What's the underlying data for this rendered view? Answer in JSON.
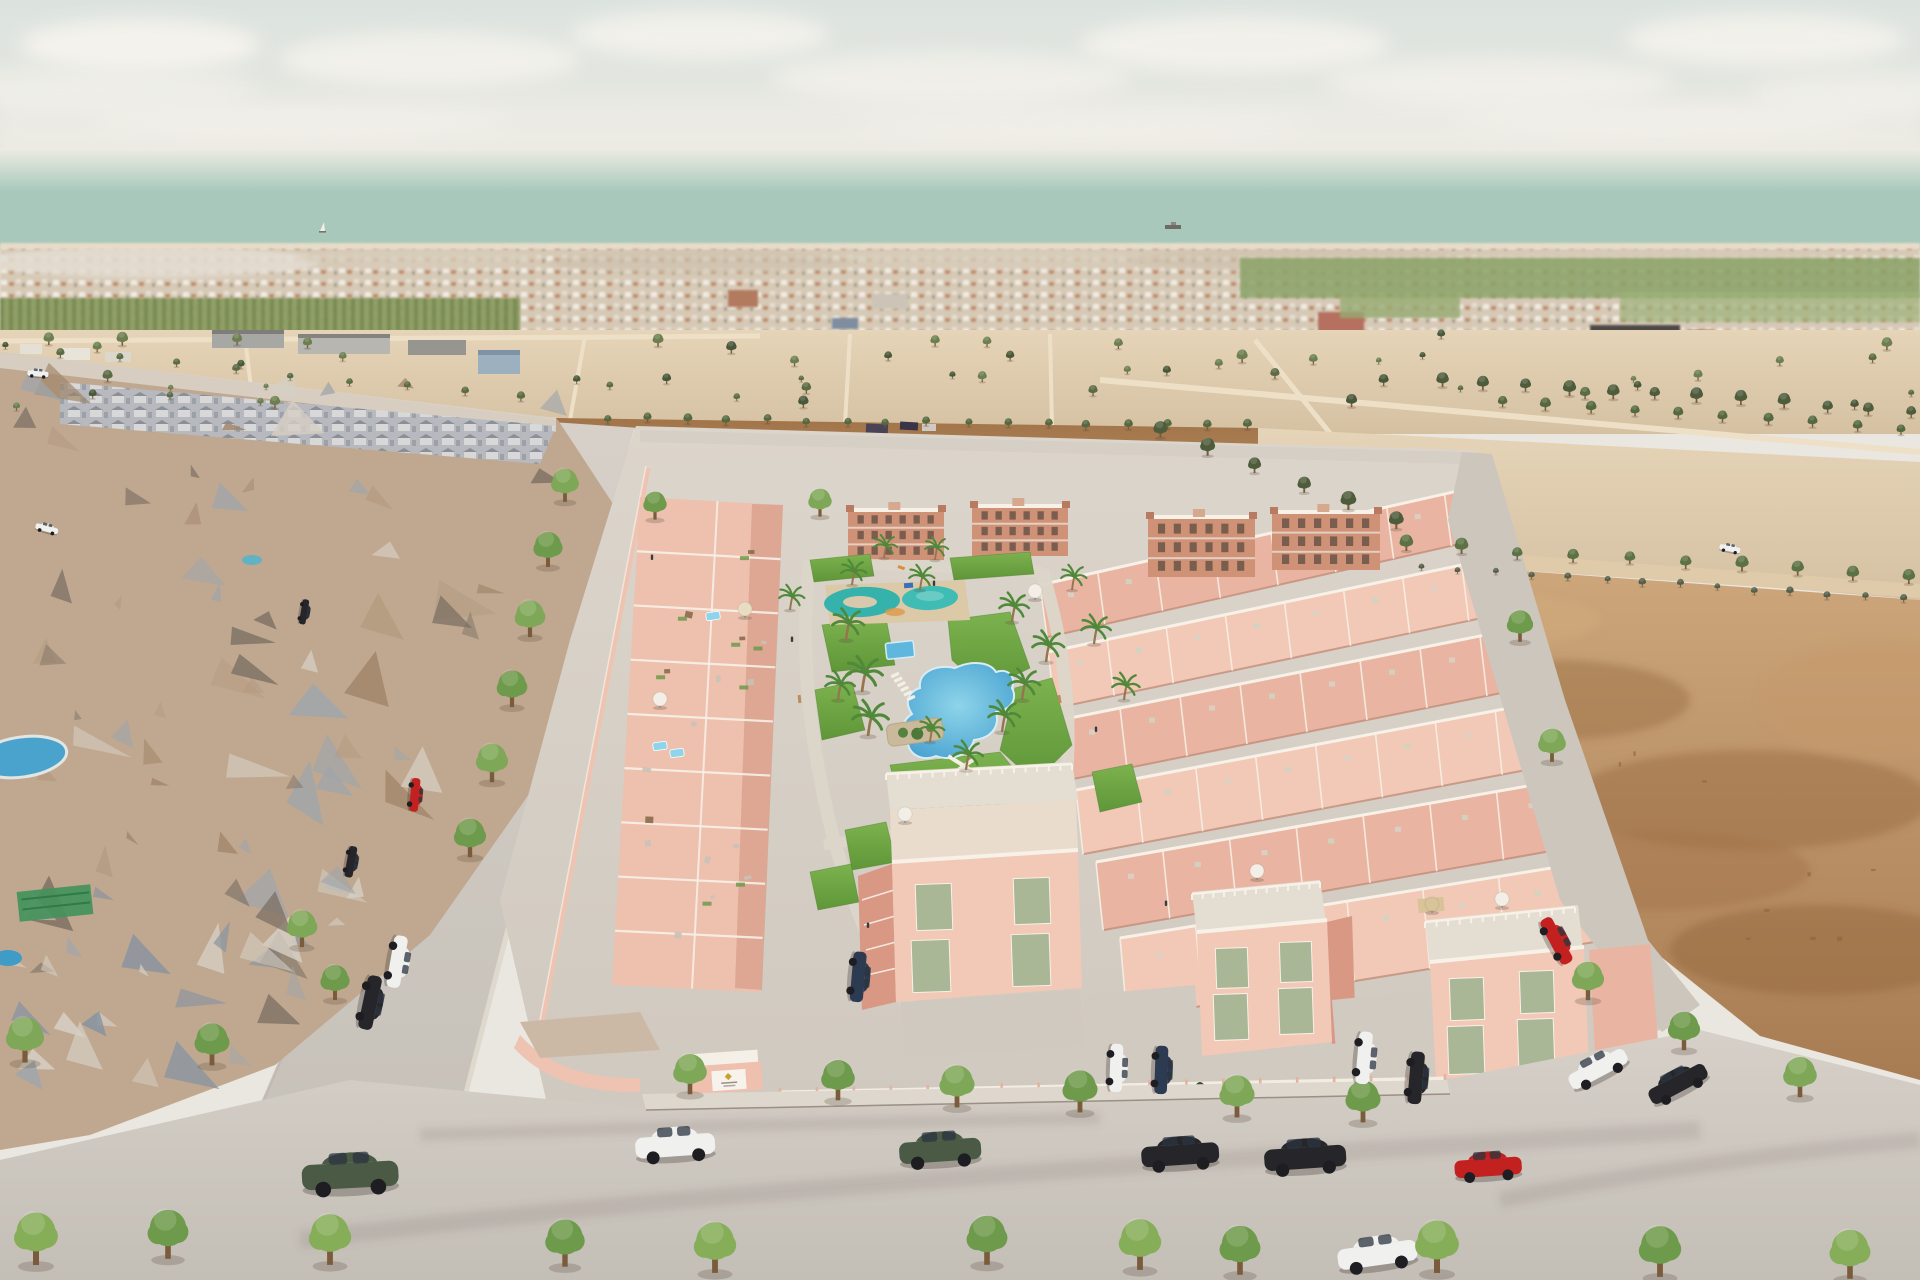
{
  "scene": {
    "kind": "aerial-architectural-render",
    "subject": "new-build pink townhouse development with communal pools beside existing photogrammetry neighbourhood, sea on horizon"
  },
  "palette": {
    "sky_top": "#dce3df",
    "sky_mid": "#e9e7e0",
    "sky_bottom": "#efeae1",
    "cloud": "#f8f5ef",
    "sea": "#a7c8bb",
    "beach": "#e8dcc8",
    "orchard": "#8d9d63",
    "field_green": "#8ba368",
    "sand_light": "#e6d4b8",
    "sand_dark": "#d5c1a2",
    "road_sand": "#eee0c7",
    "dirt_dark": "#a1744a",
    "dirt_light": "#c59a6b",
    "mesh_base": "#c0a890",
    "mesh_tan": "#b39a7f",
    "mesh_brown": "#a08468",
    "mesh_grey": "#9fa5ab",
    "mesh_blue": "#8793a0",
    "mesh_light": "#d6cfc4",
    "mesh_dark": "#7b6f63",
    "street": "#d0cac2",
    "sidewalk": "#ddd7cd",
    "ground": "#d5cec5",
    "pink_light": "#f2c8b6",
    "pink_mid": "#e9b5a2",
    "pink_dark": "#d89884",
    "pink_shadow": "#c08571",
    "white_trim": "#f8f1e8",
    "wall_pink": "#eec3b1",
    "terracotta": "#cf9277",
    "terracotta_dark": "#b87b62",
    "window_dark": "#6a5348",
    "green_shutter": "#a9b796",
    "lawn": "#6fa844",
    "pool_blue": "#47a3d2",
    "pool_teal": "#35b2ab",
    "pool_teal_light": "#7fd2cc",
    "pool_aqua": "#8ed4ea",
    "palm": "#4f8939",
    "tree": "#76a050",
    "tree_dark": "#586f41",
    "deck": "#e4ddd1",
    "planter": "#cbb99b",
    "gold": "#c9a227",
    "car_colors": {
      "white": "#f0f0ee",
      "black": "#26262a",
      "grey": "#73767a",
      "red": "#c2211f",
      "green": "#4b5a45",
      "darkblue": "#2c3a52"
    }
  },
  "sky": {
    "clouds": [
      [
        140,
        45,
        120,
        26,
        0.85
      ],
      [
        90,
        88,
        170,
        20,
        0.5
      ],
      [
        430,
        60,
        150,
        28,
        0.7
      ],
      [
        700,
        35,
        130,
        24,
        0.75
      ],
      [
        950,
        78,
        180,
        26,
        0.6
      ],
      [
        1235,
        45,
        155,
        28,
        0.75
      ],
      [
        1500,
        82,
        175,
        24,
        0.6
      ],
      [
        1765,
        40,
        140,
        26,
        0.75
      ],
      [
        1870,
        92,
        120,
        20,
        0.5
      ],
      [
        300,
        122,
        210,
        17,
        0.4
      ],
      [
        1080,
        126,
        230,
        16,
        0.35
      ],
      [
        1660,
        122,
        210,
        16,
        0.4
      ]
    ]
  },
  "sea": {
    "sailboat": [
      320,
      231
    ],
    "ship": [
      1173,
      227
    ]
  },
  "cars": [
    [
      399,
      962,
      100,
      "white",
      1.25
    ],
    [
      372,
      1003,
      102,
      "black",
      1.3
    ],
    [
      350,
      1172,
      -3,
      "green",
      2.3
    ],
    [
      47,
      528,
      15,
      "white",
      0.55
    ],
    [
      305,
      612,
      100,
      "black",
      0.6
    ],
    [
      416,
      795,
      95,
      "red",
      0.8
    ],
    [
      352,
      862,
      100,
      "black",
      0.75
    ],
    [
      675,
      1143,
      -4,
      "white",
      1.9
    ],
    [
      940,
      1148,
      -4,
      "green",
      1.95
    ],
    [
      1180,
      1152,
      -4,
      "black",
      1.85
    ],
    [
      1305,
      1155,
      -4,
      "black",
      1.95
    ],
    [
      1488,
      1165,
      -4,
      "red",
      1.6
    ],
    [
      1377,
      1252,
      -8,
      "white",
      1.9
    ],
    [
      1597,
      1067,
      -28,
      "white",
      1.5
    ],
    [
      1677,
      1082,
      -28,
      "black",
      1.5
    ],
    [
      1558,
      940,
      62,
      "red",
      1.2
    ],
    [
      860,
      977,
      95,
      "darkblue",
      1.2
    ],
    [
      1118,
      1068,
      92,
      "white",
      1.15
    ],
    [
      1163,
      1070,
      92,
      "darkblue",
      1.15
    ],
    [
      1366,
      1058,
      95,
      "white",
      1.25
    ],
    [
      1418,
      1078,
      95,
      "black",
      1.25
    ],
    [
      1730,
      548,
      12,
      "white",
      0.5
    ],
    [
      38,
      373,
      5,
      "white",
      0.5
    ]
  ],
  "trees": {
    "street": [
      [
        565,
        500,
        1.9
      ],
      [
        548,
        565,
        2.0
      ],
      [
        530,
        635,
        2.1
      ],
      [
        512,
        705,
        2.1
      ],
      [
        492,
        780,
        2.2
      ],
      [
        470,
        855,
        2.2
      ],
      [
        302,
        945,
        2.1
      ],
      [
        335,
        998,
        2.0
      ],
      [
        25,
        1060,
        2.6
      ],
      [
        212,
        1063,
        2.4
      ],
      [
        690,
        1092,
        2.3
      ],
      [
        838,
        1098,
        2.3
      ],
      [
        957,
        1105,
        2.4
      ],
      [
        1080,
        1110,
        2.4
      ],
      [
        1237,
        1115,
        2.4
      ],
      [
        1363,
        1120,
        2.4
      ],
      [
        1588,
        998,
        2.2
      ],
      [
        1684,
        1048,
        2.2
      ],
      [
        1800,
        1095,
        2.3
      ],
      [
        1520,
        640,
        1.8
      ],
      [
        1552,
        760,
        1.9
      ],
      [
        655,
        518,
        1.6
      ],
      [
        820,
        515,
        1.6
      ]
    ],
    "foreground": [
      [
        36,
        1262,
        3.0
      ],
      [
        168,
        1256,
        2.8
      ],
      [
        330,
        1262,
        2.9
      ],
      [
        565,
        1264,
        2.7
      ],
      [
        715,
        1270,
        2.9
      ],
      [
        987,
        1262,
        2.8
      ],
      [
        1140,
        1267,
        2.9
      ],
      [
        1240,
        1272,
        2.8
      ],
      [
        1437,
        1270,
        3.0
      ],
      [
        1660,
        1274,
        2.9
      ],
      [
        1850,
        1276,
        2.8
      ]
    ]
  },
  "palms": [
    [
      846,
      640,
      1.5
    ],
    [
      862,
      692,
      1.7
    ],
    [
      868,
      736,
      1.7
    ],
    [
      838,
      700,
      1.4
    ],
    [
      852,
      585,
      1.2
    ],
    [
      920,
      590,
      1.2
    ],
    [
      1012,
      622,
      1.4
    ],
    [
      1022,
      700,
      1.5
    ],
    [
      1046,
      662,
      1.5
    ],
    [
      1002,
      732,
      1.5
    ],
    [
      966,
      770,
      1.4
    ],
    [
      1072,
      590,
      1.2
    ],
    [
      1094,
      644,
      1.4
    ],
    [
      935,
      560,
      1.1
    ],
    [
      884,
      558,
      1.1
    ],
    [
      790,
      610,
      1.2
    ],
    [
      1124,
      700,
      1.3
    ],
    [
      930,
      742,
      1.2
    ]
  ],
  "umbrellas": [
    [
      745,
      610,
      "#e8dcc2"
    ],
    [
      905,
      815,
      "#f4efe6"
    ],
    [
      1257,
      872,
      "#f4efe6"
    ],
    [
      1502,
      900,
      "#f4efe6"
    ],
    [
      660,
      700,
      "#f4efe6"
    ],
    [
      1432,
      905,
      "#d9c49a"
    ],
    [
      1035,
      592,
      "#f4efe6"
    ]
  ],
  "loungers": {
    "x": 895,
    "y": 675,
    "n": 6,
    "dx": 3.2,
    "dy": 4.6,
    "rot": -25,
    "extra": [
      [
        1228,
        930
      ],
      [
        1240,
        936
      ]
    ]
  },
  "aqua_pools": [
    [
      660,
      746
    ],
    [
      677,
      753
    ],
    [
      713,
      616
    ]
  ],
  "people": [
    [
      868,
      928
    ],
    [
      792,
      642
    ],
    [
      1096,
      732
    ],
    [
      934,
      586
    ],
    [
      1166,
      906
    ],
    [
      652,
      560
    ]
  ],
  "generated": {
    "mesh_triangles": {
      "count": 95,
      "seed": 7
    },
    "scatter_trees": {
      "count": 55,
      "seed": 11,
      "y0": 338,
      "y1": 420
    },
    "field_specks": {
      "count": 12,
      "seed": 31
    },
    "tree_rows": [
      {
        "x1": 605,
        "y1": 421,
        "x2": 1245,
        "y2": 429,
        "n": 17,
        "s": 0.55,
        "color": "#55683f"
      },
      {
        "x1": 1405,
        "y1": 549,
        "x2": 1905,
        "y2": 581,
        "n": 10,
        "s": 0.85,
        "color": "#5d7244"
      },
      {
        "x1": 1160,
        "y1": 436,
        "x2": 1395,
        "y2": 526,
        "n": 6,
        "s": 0.95,
        "color": "#4e5c3c"
      },
      {
        "x1": 60,
        "y1": 355,
        "x2": 520,
        "y2": 400,
        "n": 9,
        "s": 0.5,
        "color": "#5b6b44"
      },
      {
        "x1": 1440,
        "y1": 385,
        "x2": 1910,
        "y2": 415,
        "n": 12,
        "s": 0.8,
        "color": "#4e5c3c"
      },
      {
        "x1": 1500,
        "y1": 405,
        "x2": 1900,
        "y2": 432,
        "n": 10,
        "s": 0.7,
        "color": "#55683f"
      },
      {
        "x1": 1420,
        "y1": 568,
        "x2": 1900,
        "y2": 602,
        "n": 14,
        "s": 0.45,
        "color": "#55604a"
      }
    ]
  },
  "development": {
    "apartments": [
      {
        "x": 848,
        "y": 508,
        "w": 96,
        "h": 52
      },
      {
        "x": 972,
        "y": 504,
        "w": 96,
        "h": 52
      },
      {
        "x": 1148,
        "y": 515,
        "w": 107,
        "h": 62
      },
      {
        "x": 1272,
        "y": 510,
        "w": 108,
        "h": 60
      }
    ],
    "apartment_window_cols": 6,
    "left_block": {
      "quad": [
        [
          640,
          497
        ],
        [
          783,
          505
        ],
        [
          760,
          992
        ],
        [
          612,
          985
        ]
      ],
      "divisions": 9,
      "seed": 21
    },
    "right_strips": [
      {
        "a": [
          1040,
          585
        ],
        "b": [
          1560,
          468
        ],
        "h": 52,
        "units": 9
      },
      {
        "a": [
          1048,
          652
        ],
        "b": [
          1580,
          540
        ],
        "h": 56,
        "units": 9
      },
      {
        "a": [
          1060,
          720
        ],
        "b": [
          1600,
          612
        ],
        "h": 60,
        "units": 9
      },
      {
        "a": [
          1076,
          790
        ],
        "b": [
          1615,
          688
        ],
        "h": 64,
        "units": 9
      },
      {
        "a": [
          1096,
          862
        ],
        "b": [
          1630,
          768
        ],
        "h": 68,
        "units": 8
      },
      {
        "a": [
          1120,
          938
        ],
        "b": [
          1650,
          852
        ],
        "h": 80,
        "units": 7
      }
    ],
    "fence": {
      "x1": 780,
      "y1": 1094,
      "x2": 1445,
      "y2": 1080,
      "posts": 18
    },
    "balustrades": [
      {
        "x1": 886,
        "y1": 774,
        "x2": 1072,
        "y2": 764,
        "n": 16
      },
      {
        "x1": 1192,
        "y1": 894,
        "x2": 1320,
        "y2": 882,
        "n": 12
      },
      {
        "x1": 1425,
        "y1": 922,
        "x2": 1575,
        "y2": 907,
        "n": 13
      }
    ]
  }
}
